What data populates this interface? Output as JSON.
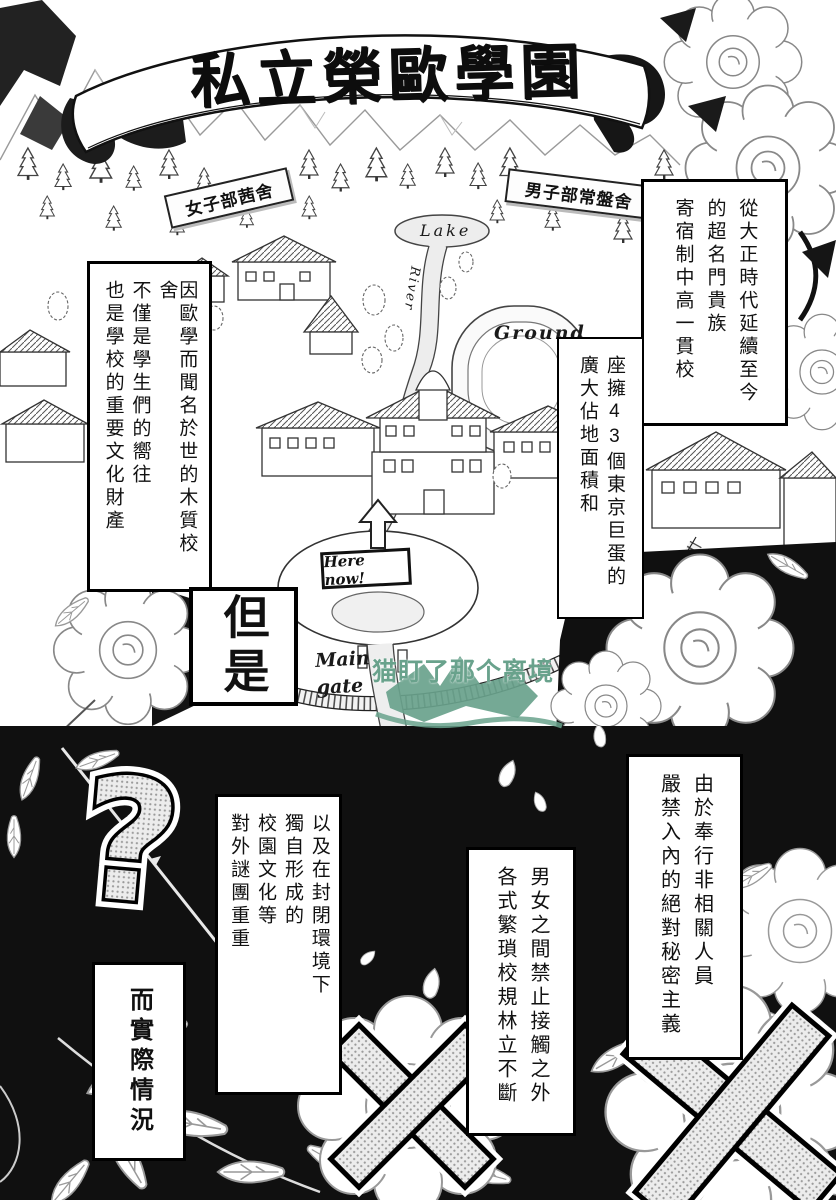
{
  "banner": {
    "title": "私立榮歐學園"
  },
  "map": {
    "girls_dorm_label": "女子部茜舍",
    "boys_dorm_label": "男子部常盤舍",
    "lake_label": "Lake",
    "river_label": "River",
    "ground_label": "Ground",
    "here_now_label": "Here now!",
    "main_gate_label": "Main gate"
  },
  "captions": {
    "history": {
      "lines": [
        "從大正時代延續至今",
        "的超名門貴族",
        "寄宿制中高一貫校"
      ]
    },
    "area": {
      "lines": [
        "座擁43個東京巨蛋的",
        "廣大佔地面積和"
      ]
    },
    "heritage": {
      "lines": [
        "因歐學而聞名於世的木質校舍",
        "不僅是學生們的嚮往",
        "也是學校的重要文化財產"
      ]
    },
    "transition": {
      "text": "但是"
    },
    "secrecy": {
      "lines": [
        "由於奉行非相關人員",
        "嚴禁入內的絕對秘密主義"
      ]
    },
    "rules": {
      "lines": [
        "男女之間禁止接觸之外",
        "各式繁瑣校規林立不斷"
      ]
    },
    "culture": {
      "lines": [
        "以及在封閉環境下",
        "獨自形成的",
        "校園文化等",
        "對外謎團重重"
      ]
    },
    "reality": {
      "text": "而實際情況"
    }
  },
  "watermark": {
    "text": "猫盯了那个离境",
    "color": "#69a28c"
  },
  "symbols": {
    "question_mark": "?"
  },
  "colors": {
    "ink": "#111111",
    "panel_black": "#101010",
    "screentone_dot": "#9a9a9a",
    "watermark_green": "#69a28c"
  }
}
